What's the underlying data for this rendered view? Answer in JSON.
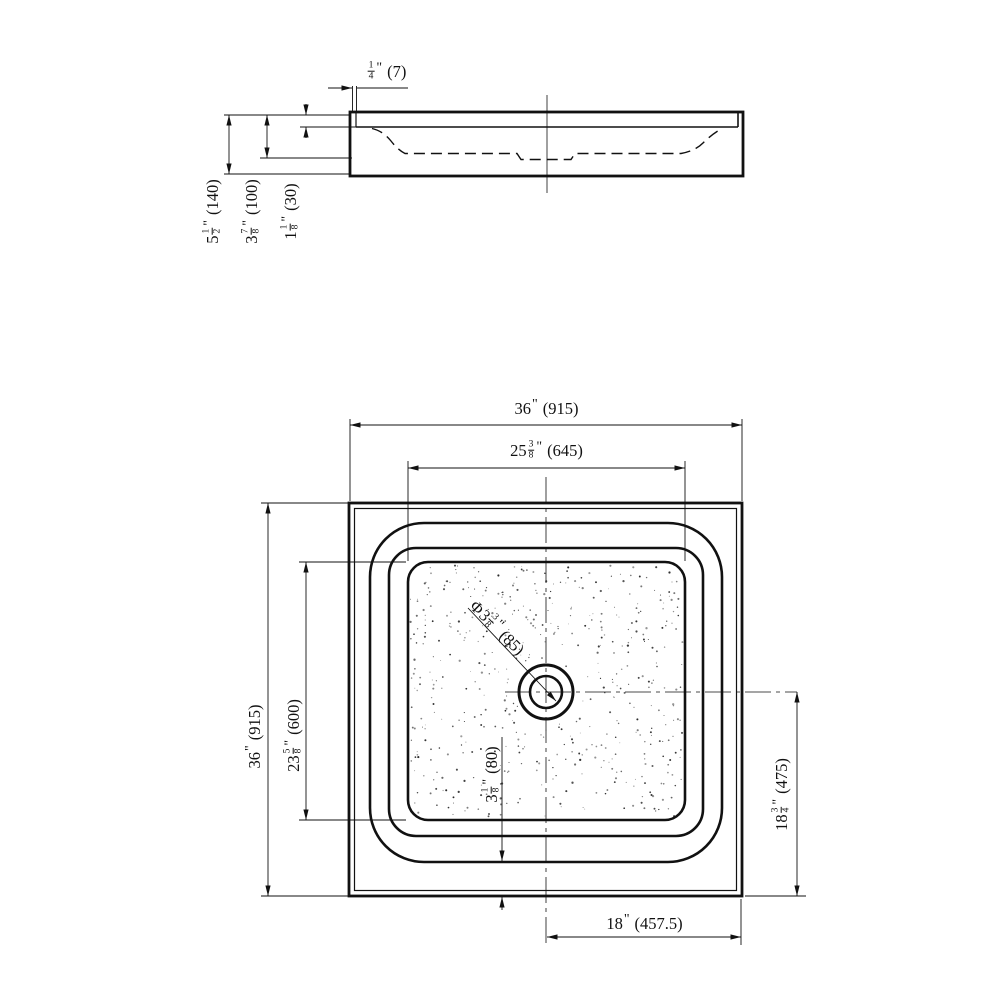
{
  "drawing_title": "shower-base-technical-drawing",
  "colors": {
    "line": "#111111",
    "background": "#ffffff"
  },
  "labels": {
    "side_lip_thickness": {
      "prefix": "",
      "whole": "",
      "num": "1",
      "den": "4",
      "unit": "\"",
      "mm": "(7)"
    },
    "side_total_height": {
      "prefix": "",
      "whole": "5",
      "num": "1",
      "den": "2",
      "unit": "\"",
      "mm": "(140)"
    },
    "side_basin_depth": {
      "prefix": "",
      "whole": "3",
      "num": "7",
      "den": "8",
      "unit": "\"",
      "mm": "(100)"
    },
    "side_rim_height": {
      "prefix": "",
      "whole": "1",
      "num": "1",
      "den": "8",
      "unit": "\"",
      "mm": "(30)"
    },
    "plan_overall_width": {
      "prefix": "",
      "whole": "36",
      "num": "",
      "den": "",
      "unit": "\"",
      "mm": "(915)"
    },
    "plan_floor_width": {
      "prefix": "",
      "whole": "25",
      "num": "3",
      "den": "8",
      "unit": "\"",
      "mm": "(645)"
    },
    "plan_overall_depth": {
      "prefix": "",
      "whole": "36",
      "num": "",
      "den": "",
      "unit": "\"",
      "mm": "(915)"
    },
    "plan_floor_depth": {
      "prefix": "",
      "whole": "23",
      "num": "5",
      "den": "8",
      "unit": "\"",
      "mm": "(600)"
    },
    "drain_diameter": {
      "prefix": "Φ",
      "whole": "3",
      "num": "3",
      "den": "8",
      "unit": "\"",
      "mm": "(85)"
    },
    "apron_width": {
      "prefix": "",
      "whole": "3",
      "num": "1",
      "den": "8",
      "unit": "\"",
      "mm": "(80)"
    },
    "drain_offset_vertical": {
      "prefix": "",
      "whole": "18",
      "num": "3",
      "den": "4",
      "unit": "\"",
      "mm": "(475)"
    },
    "drain_offset_horizontal": {
      "prefix": "",
      "whole": "18",
      "num": "",
      "den": "",
      "unit": "\"",
      "mm": "(457.5)"
    }
  },
  "stipple": {
    "dot_count": 540
  }
}
